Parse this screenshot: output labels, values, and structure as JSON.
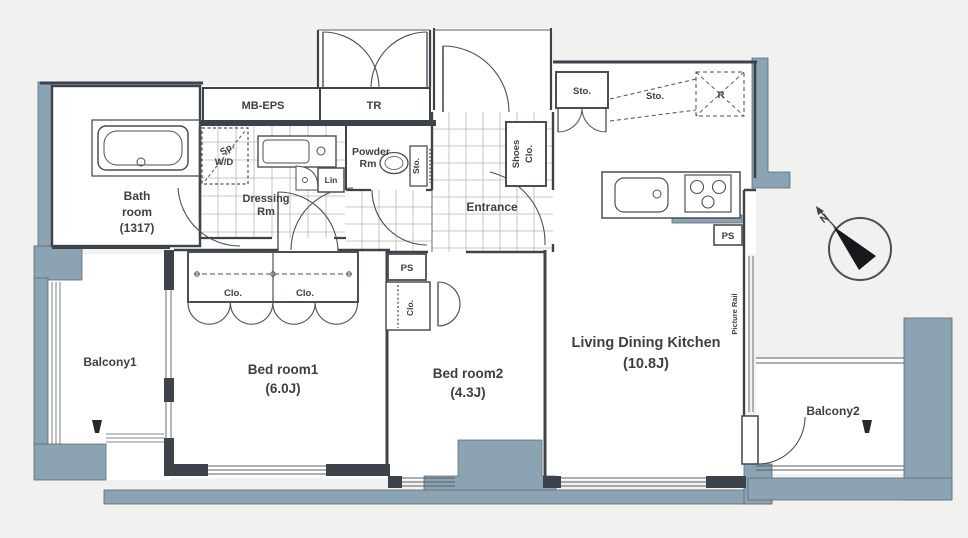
{
  "plan_title": "apartment-floor-plan",
  "colors": {
    "wall_line": "#3d434b",
    "balcony_fill": "#8ba3b2",
    "background": "#f1f1ef",
    "floor": "#ffffff",
    "grid_line": "#b6b6b4",
    "text": "#3f3f3f"
  },
  "labels": {
    "mb_eps": "MB-EPS",
    "tr": "TR",
    "bath": [
      "Bath",
      "room",
      "(1317)"
    ],
    "washer": [
      "Sp.",
      "W/D"
    ],
    "dressing": [
      "Dressing",
      "Rm"
    ],
    "powder": [
      "Powder",
      "Rm"
    ],
    "lin": "Lin",
    "sto_toilet": "Sto.",
    "entrance": "Entrance",
    "shoes_clo": [
      "Shoes",
      "Clo."
    ],
    "sto_closet": "Sto.",
    "sto_dashed": "Sto.",
    "fridge": "R",
    "ps_kitchen": "PS",
    "ps_bed2": "PS",
    "clo_bed2": "Clo.",
    "clo_bed1_left": "Clo.",
    "clo_bed1_right": "Clo.",
    "bed1": [
      "Bed room1",
      "(6.0J)"
    ],
    "bed2": [
      "Bed room2",
      "(4.3J)"
    ],
    "ldk": [
      "Living Dining Kitchen",
      "(10.8J)"
    ],
    "balcony1": "Balcony1",
    "balcony2": "Balcony2",
    "picture_rail": "Picture Rail",
    "north": "N"
  }
}
